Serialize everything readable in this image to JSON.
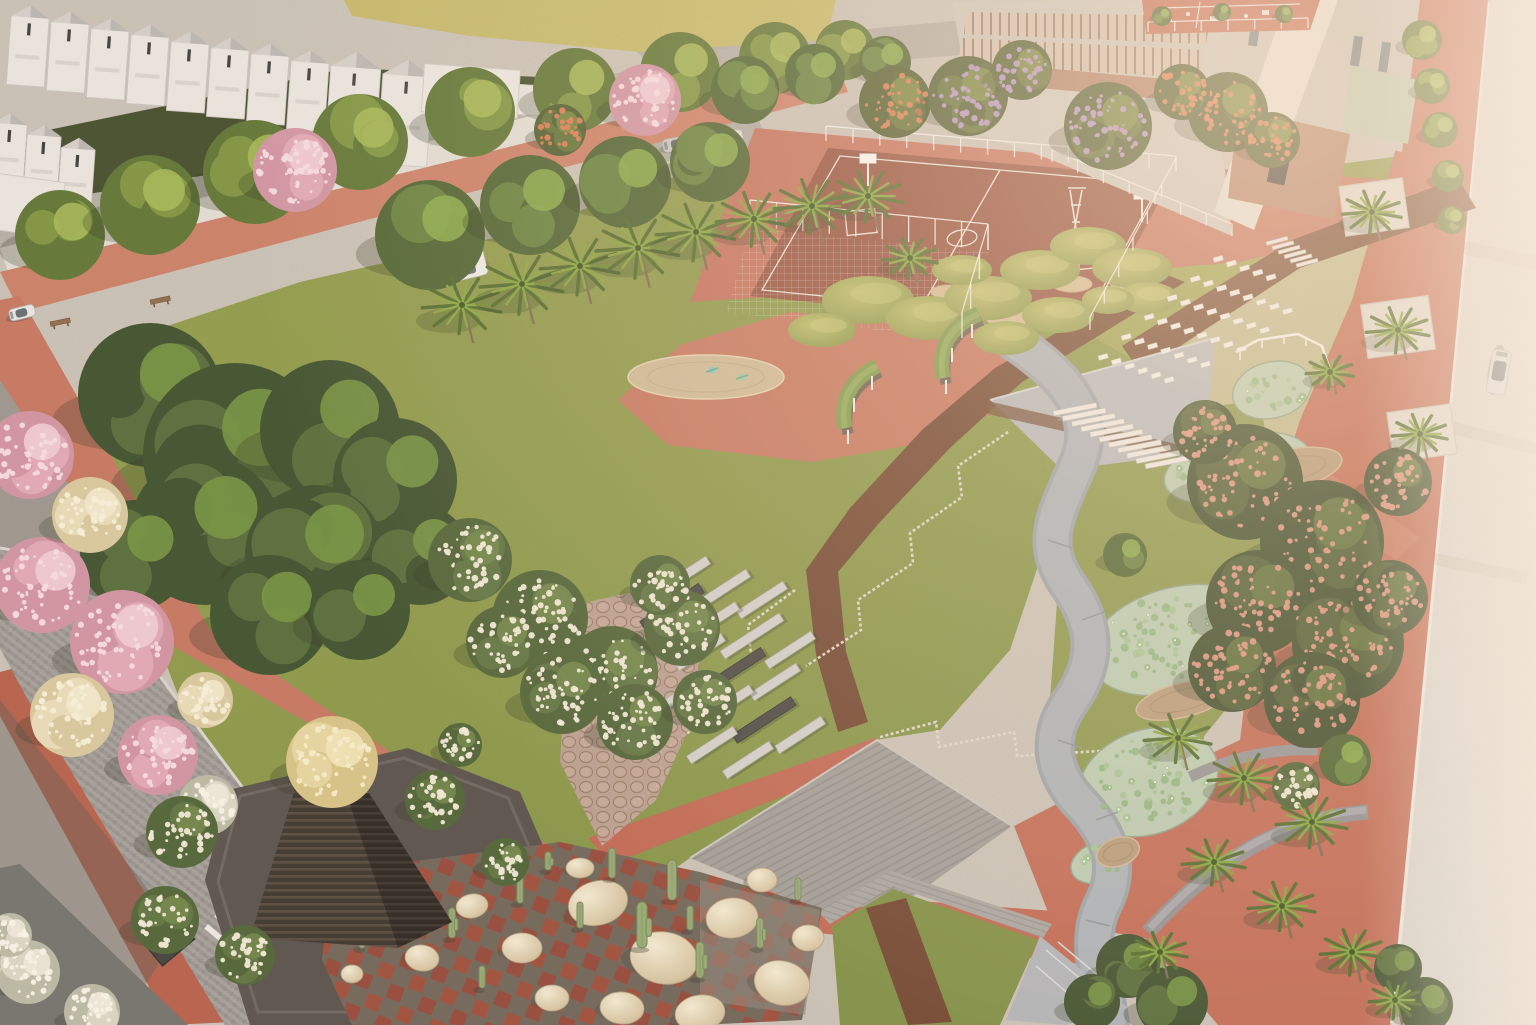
{
  "meta": {
    "type": "aerial-architectural-render",
    "description": "Sunlit aerial rendering of a landscaped community park: white gabled townhouses and a school campus at top, basketball courts, a large central lawn ringed by terracotta jogging tracks, flowering trees, palm rows, a lotus pond with curving grey walkway, grassy play mounds with white seat rows, a dark stepped pyramid pavilion, a cactus rock garden, timber decks and a pale road with a car on the right.",
    "width": 1536,
    "height": 1025
  },
  "palette": {
    "lawn": "#8d9c4a",
    "lawn_bright": "#b8b95e",
    "lawn_dark": "#7e8f44",
    "track_red": "#c4765f",
    "plaza_red": "#bf6752",
    "mulch_brown": "#70452f",
    "road_light": "#dfdbd4",
    "cobble_grey": "#a4a09b",
    "concrete": "#b4b7bb",
    "deck_wood": "#a09d98",
    "pond_water": "#b9cbb1",
    "lily_green": "#8fb580",
    "pyramid_dark": "#3a332c",
    "boulder_beige": "#d6c5a2",
    "cactus_green": "#96aa74",
    "house_white": "#e9e6e0",
    "brick": "#ad7f66",
    "glass_warm": "#d2bfae",
    "blossom_pink": "#dfa7b4",
    "blossom_cream": "#ecdfc0",
    "bloom_white": "#f1ead8",
    "flame_orange": "#dd7a50",
    "jacaranda_purple": "#b593c6",
    "salmon_bloom": "#dd9480",
    "haze": "#ffe8cd",
    "treeTypes": {
      "gd": {
        "base": "#3c4f2c",
        "mid": "#546b38",
        "hi": "#71913f"
      },
      "gr": {
        "base": "#4c6230",
        "mid": "#64803c",
        "hi": "#86a848"
      },
      "gy": {
        "base": "#5d7433",
        "mid": "#7d9440",
        "hi": "#a3b654"
      },
      "pk": {
        "base": "#cf93a2",
        "mid": "#dfa7b4",
        "hi": "#f0cdd5",
        "dots": "#f6dce2"
      },
      "cr": {
        "base": "#d8c89e",
        "mid": "#e8dbb8",
        "hi": "#f2e9cc",
        "dots": "#f7f0da"
      },
      "wh": {
        "base": "#b9b9a4",
        "mid": "#d9d7c4",
        "hi": "#eeeadb",
        "dots": "#f7f4e8"
      },
      "ws": {
        "base": "#4e6236",
        "mid": "#5d7340",
        "hi": "#6f8648",
        "dots": "#f1ead8"
      },
      "fl": {
        "base": "#4e5c2e",
        "mid": "#5f7036",
        "hi": "#74863c",
        "dots": "#dd7a50"
      },
      "pu": {
        "base": "#4e5c32",
        "mid": "#5f7038",
        "hi": "#74863e",
        "dots": "#b593c6"
      },
      "sa": {
        "base": "#3d4d2b",
        "mid": "#4c5c32",
        "hi": "#5d7038",
        "dots": "#dd9480"
      },
      "yc": {
        "base": "#d5c286",
        "mid": "#e6d6a0",
        "hi": "#f0e4b6",
        "dots": "#f6edc8"
      }
    }
  },
  "scene": {
    "trees": [
      [
        60,
        235,
        45,
        "gy"
      ],
      [
        150,
        205,
        50,
        "gy"
      ],
      [
        255,
        172,
        52,
        "gy"
      ],
      [
        360,
        142,
        48,
        "gy"
      ],
      [
        470,
        112,
        45,
        "gy"
      ],
      [
        575,
        90,
        42,
        "gy"
      ],
      [
        680,
        72,
        40,
        "gy"
      ],
      [
        775,
        58,
        36,
        "gy"
      ],
      [
        845,
        50,
        30,
        "gy"
      ],
      [
        430,
        235,
        55,
        "gr"
      ],
      [
        530,
        205,
        50,
        "gr"
      ],
      [
        625,
        182,
        46,
        "gr"
      ],
      [
        710,
        162,
        40,
        "gr"
      ],
      [
        295,
        170,
        42,
        "pk"
      ],
      [
        645,
        100,
        36,
        "pk"
      ],
      [
        745,
        90,
        34,
        "gr"
      ],
      [
        815,
        74,
        30,
        "gr"
      ],
      [
        885,
        62,
        26,
        "gr"
      ],
      [
        895,
        102,
        36,
        "fl"
      ],
      [
        1228,
        112,
        40,
        "fl"
      ],
      [
        1272,
        140,
        28,
        "fl"
      ],
      [
        560,
        130,
        26,
        "fl"
      ],
      [
        1182,
        92,
        28,
        "fl"
      ],
      [
        968,
        96,
        40,
        "pu"
      ],
      [
        1108,
        126,
        44,
        "pu"
      ],
      [
        1022,
        70,
        30,
        "pu"
      ],
      [
        150,
        395,
        72,
        "gd"
      ],
      [
        235,
        455,
        92,
        "gd"
      ],
      [
        330,
        430,
        70,
        "gd"
      ],
      [
        395,
        480,
        62,
        "gd"
      ],
      [
        205,
        530,
        75,
        "gd"
      ],
      [
        315,
        555,
        70,
        "gd"
      ],
      [
        135,
        555,
        55,
        "gd"
      ],
      [
        420,
        555,
        50,
        "gd"
      ],
      [
        270,
        615,
        60,
        "gd"
      ],
      [
        360,
        610,
        50,
        "gd"
      ],
      [
        30,
        455,
        44,
        "pk"
      ],
      [
        42,
        585,
        48,
        "pk"
      ],
      [
        122,
        642,
        52,
        "pk"
      ],
      [
        158,
        755,
        40,
        "pk"
      ],
      [
        90,
        515,
        38,
        "cr"
      ],
      [
        72,
        715,
        42,
        "cr"
      ],
      [
        205,
        700,
        28,
        "cr"
      ],
      [
        208,
        805,
        30,
        "wh"
      ],
      [
        28,
        972,
        32,
        "wh"
      ],
      [
        92,
        1012,
        28,
        "wh"
      ],
      [
        10,
        935,
        22,
        "wh"
      ],
      [
        470,
        560,
        42,
        "ws"
      ],
      [
        540,
        618,
        48,
        "ws"
      ],
      [
        612,
        672,
        46,
        "ws"
      ],
      [
        682,
        628,
        38,
        "ws"
      ],
      [
        562,
        692,
        42,
        "ws"
      ],
      [
        635,
        722,
        38,
        "ws"
      ],
      [
        502,
        642,
        36,
        "ws"
      ],
      [
        705,
        702,
        32,
        "ws"
      ],
      [
        660,
        585,
        30,
        "ws"
      ],
      [
        182,
        832,
        36,
        "ws"
      ],
      [
        435,
        800,
        30,
        "ws"
      ],
      [
        505,
        862,
        24,
        "ws"
      ],
      [
        460,
        745,
        22,
        "ws"
      ],
      [
        165,
        920,
        34,
        "ws"
      ],
      [
        245,
        955,
        30,
        "ws"
      ],
      [
        1296,
        786,
        24,
        "ws"
      ],
      [
        332,
        762,
        46,
        "yc"
      ],
      [
        1245,
        482,
        58,
        "sa"
      ],
      [
        1322,
        542,
        62,
        "sa"
      ],
      [
        1258,
        602,
        52,
        "sa"
      ],
      [
        1348,
        644,
        56,
        "sa"
      ],
      [
        1232,
        668,
        44,
        "sa"
      ],
      [
        1312,
        700,
        48,
        "sa"
      ],
      [
        1390,
        598,
        38,
        "sa"
      ],
      [
        1398,
        482,
        34,
        "sa"
      ],
      [
        1205,
        432,
        32,
        "sa"
      ],
      [
        1128,
        966,
        32,
        "gd"
      ],
      [
        1172,
        1002,
        36,
        "gd"
      ],
      [
        1092,
        1002,
        28,
        "gd"
      ],
      [
        1398,
        968,
        24,
        "gd"
      ],
      [
        1425,
        1005,
        28,
        "gd"
      ],
      [
        1422,
        40,
        20,
        "gy"
      ],
      [
        1432,
        86,
        18,
        "gy"
      ],
      [
        1440,
        130,
        18,
        "gy"
      ],
      [
        1448,
        176,
        16,
        "gy"
      ],
      [
        1452,
        220,
        14,
        "gy"
      ],
      [
        1162,
        16,
        10,
        "gr"
      ],
      [
        1222,
        12,
        9,
        "gr"
      ],
      [
        1284,
        14,
        9,
        "gr"
      ],
      [
        1125,
        555,
        22,
        "gr"
      ],
      [
        1345,
        760,
        26,
        "gr"
      ]
    ],
    "palms": [
      [
        462,
        305,
        40
      ],
      [
        522,
        284,
        42
      ],
      [
        580,
        266,
        40
      ],
      [
        638,
        248,
        42
      ],
      [
        696,
        232,
        40
      ],
      [
        754,
        219,
        38
      ],
      [
        812,
        206,
        38
      ],
      [
        868,
        196,
        36
      ],
      [
        910,
        258,
        28
      ],
      [
        1372,
        212,
        30
      ],
      [
        1398,
        330,
        32
      ],
      [
        1420,
        434,
        28
      ],
      [
        1330,
        372,
        24
      ],
      [
        1178,
        738,
        34
      ],
      [
        1244,
        778,
        36
      ],
      [
        1312,
        822,
        36
      ],
      [
        1214,
        862,
        32
      ],
      [
        1282,
        906,
        34
      ],
      [
        1352,
        952,
        32
      ],
      [
        1160,
        952,
        28
      ],
      [
        1395,
        1000,
        26
      ]
    ],
    "mounds": [
      [
        868,
        300,
        46,
        24
      ],
      [
        928,
        318,
        42,
        22
      ],
      [
        988,
        298,
        44,
        22
      ],
      [
        1040,
        270,
        40,
        20
      ],
      [
        1088,
        246,
        38,
        19
      ],
      [
        1132,
        268,
        40,
        20
      ],
      [
        1058,
        315,
        36,
        18
      ],
      [
        1006,
        338,
        33,
        17
      ],
      [
        1148,
        298,
        30,
        16
      ],
      [
        822,
        330,
        34,
        17
      ],
      [
        962,
        270,
        30,
        15
      ],
      [
        1108,
        300,
        26,
        14
      ]
    ],
    "sand": [
      [
        900,
        312,
        26,
        11
      ],
      [
        1008,
        318,
        22,
        9
      ],
      [
        1072,
        284,
        20,
        8
      ],
      [
        948,
        292,
        17,
        7
      ],
      [
        1124,
        284,
        14,
        6
      ]
    ],
    "seatRows": [
      [
        1213,
        258,
        5
      ],
      [
        1190,
        278,
        8
      ],
      [
        1167,
        297,
        8
      ],
      [
        1144,
        316,
        8
      ],
      [
        1121,
        336,
        7
      ],
      [
        1098,
        356,
        6
      ]
    ],
    "stairs": [
      {
        "x": 1053,
        "y": 411,
        "n": 11,
        "dx": 9.2,
        "dy": 5.3,
        "w": 44,
        "h": 5,
        "rot": -11
      },
      {
        "x": 1266,
        "y": 242,
        "n": 6,
        "dx": 6,
        "dy": 4.4,
        "w": 22,
        "h": 3.5,
        "rot": -15
      },
      {
        "x": 228,
        "y": 900,
        "n": 3,
        "dx": -10,
        "dy": 12,
        "w": 74,
        "h": 6,
        "rot": 40
      }
    ],
    "benchBars": [
      [
        685,
        575,
        55,
        9,
        "l"
      ],
      [
        725,
        588,
        55,
        9,
        "l"
      ],
      [
        762,
        600,
        55,
        9,
        "l"
      ],
      [
        672,
        607,
        70,
        11,
        "d"
      ],
      [
        712,
        622,
        60,
        9,
        "l"
      ],
      [
        752,
        636,
        70,
        9,
        "l"
      ],
      [
        790,
        650,
        55,
        9,
        "l"
      ],
      [
        700,
        652,
        55,
        9,
        "l"
      ],
      [
        738,
        668,
        60,
        10,
        "d"
      ],
      [
        775,
        682,
        55,
        9,
        "l"
      ],
      [
        688,
        690,
        55,
        9,
        "l"
      ],
      [
        726,
        705,
        60,
        9,
        "l"
      ],
      [
        764,
        720,
        70,
        10,
        "d"
      ],
      [
        800,
        735,
        55,
        9,
        "l"
      ],
      [
        712,
        745,
        55,
        9,
        "l"
      ],
      [
        748,
        760,
        55,
        9,
        "l"
      ]
    ],
    "boulders": [
      [
        598,
        903,
        30,
        22,
        -15
      ],
      [
        664,
        958,
        34,
        26,
        10
      ],
      [
        732,
        918,
        26,
        20,
        -5
      ],
      [
        782,
        983,
        28,
        22,
        15
      ],
      [
        522,
        948,
        20,
        15,
        0
      ],
      [
        472,
        906,
        16,
        12,
        -10
      ],
      [
        422,
        958,
        17,
        13,
        8
      ],
      [
        382,
        914,
        12,
        10,
        0
      ],
      [
        352,
        974,
        11,
        9,
        0
      ],
      [
        622,
        1008,
        22,
        16,
        5
      ],
      [
        700,
        1013,
        25,
        18,
        -8
      ],
      [
        552,
        998,
        17,
        13,
        0
      ],
      [
        762,
        880,
        15,
        12,
        0
      ],
      [
        808,
        938,
        16,
        13,
        0
      ],
      [
        580,
        868,
        14,
        10,
        0
      ]
    ],
    "cacti": [
      [
        642,
        948,
        46
      ],
      [
        672,
        900,
        40
      ],
      [
        612,
        878,
        30
      ],
      [
        700,
        978,
        36
      ],
      [
        580,
        928,
        26
      ],
      [
        520,
        903,
        28
      ],
      [
        452,
        938,
        30
      ],
      [
        402,
        898,
        26
      ],
      [
        362,
        948,
        20
      ],
      [
        760,
        948,
        30
      ],
      [
        798,
        900,
        22
      ],
      [
        482,
        988,
        22
      ],
      [
        548,
        870,
        18
      ],
      [
        690,
        930,
        24
      ]
    ],
    "houses": {
      "rot": 4,
      "row1": [
        [
          12,
          4,
          38
        ],
        [
          52,
          10,
          38
        ],
        [
          92,
          17,
          38
        ],
        [
          132,
          23,
          38
        ],
        [
          172,
          30,
          38
        ],
        [
          212,
          36,
          38
        ],
        [
          252,
          42,
          38
        ],
        [
          292,
          49,
          38
        ],
        [
          332,
          50,
          50
        ],
        [
          384,
          58,
          50
        ]
      ],
      "row2": [
        [
          -6,
          112,
          34
        ],
        [
          28,
          124,
          34
        ],
        [
          62,
          137,
          34
        ]
      ]
    },
    "lilyPonds": [
      [
        1272,
        390,
        40,
        28,
        -15
      ],
      [
        1237,
        468,
        74,
        34,
        -12
      ],
      [
        1175,
        640,
        88,
        52,
        -16
      ],
      [
        1148,
        782,
        72,
        52,
        -20
      ],
      [
        1100,
        862,
        30,
        20,
        -20
      ]
    ],
    "pondDecks": [
      [
        1287,
        470,
        56,
        20,
        -12
      ],
      [
        1183,
        700,
        48,
        17,
        -14
      ],
      [
        1118,
        852,
        22,
        14,
        -18
      ]
    ],
    "zigzags": [
      [
        [
          1008,
          432
        ],
        [
          958,
          466
        ],
        [
          962,
          497
        ],
        [
          910,
          533
        ],
        [
          913,
          563
        ],
        [
          858,
          600
        ],
        [
          861,
          630
        ],
        [
          806,
          666
        ]
      ],
      [
        [
          795,
          590
        ],
        [
          748,
          625
        ],
        [
          751,
          655
        ],
        [
          704,
          690
        ],
        [
          707,
          719
        ],
        [
          660,
          753
        ],
        [
          663,
          782
        ],
        [
          616,
          816
        ]
      ],
      [
        [
          880,
          737
        ],
        [
          936,
          722
        ],
        [
          939,
          747
        ],
        [
          1014,
          732
        ],
        [
          1017,
          756
        ],
        [
          1148,
          748
        ]
      ]
    ],
    "fences": [
      {
        "x1": 826,
        "y1": 141,
        "x2": 1176,
        "y2": 171,
        "h": 15
      },
      {
        "x1": 1176,
        "y1": 171,
        "x2": 1090,
        "y2": 330,
        "h": 13
      },
      {
        "x1": 750,
        "y1": 226,
        "x2": 988,
        "y2": 250,
        "h": 26
      },
      {
        "x1": 988,
        "y1": 250,
        "x2": 962,
        "y2": 338,
        "h": 26
      },
      {
        "x1": 1052,
        "y1": 162,
        "x2": 1232,
        "y2": 236,
        "h": 12
      },
      {
        "x1": 1148,
        "y1": 32,
        "x2": 1308,
        "y2": 28,
        "h": 10
      }
    ],
    "planters": [
      [
        1342,
        182,
        64,
        50,
        -8
      ],
      [
        1364,
        300,
        68,
        54,
        -8
      ],
      [
        1390,
        408,
        64,
        50,
        -8
      ],
      [
        148,
        926,
        42,
        30,
        -40
      ]
    ],
    "cars": [
      [
        428,
        262,
        -14,
        56,
        26,
        "#ececea",
        1
      ],
      [
        1512,
        352,
        100,
        44,
        19,
        "#d3d6d8",
        0
      ],
      [
        662,
        140,
        -10,
        32,
        13,
        "#c9c9c7",
        0
      ],
      [
        712,
        134,
        -10,
        30,
        13,
        "#dcdcda",
        0
      ],
      [
        870,
        52,
        -8,
        30,
        12,
        "#d6d6d4",
        0
      ],
      [
        8,
        310,
        -14,
        26,
        12,
        "#e8e8e6",
        0
      ]
    ],
    "parkBenches": [
      [
        50,
        322
      ],
      [
        150,
        300
      ],
      [
        412,
        210
      ]
    ]
  }
}
